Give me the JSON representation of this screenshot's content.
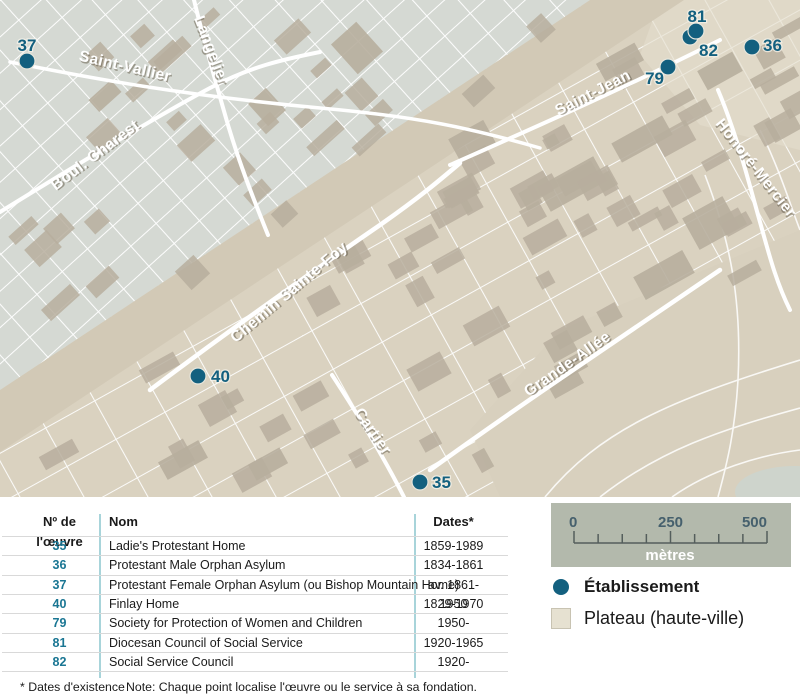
{
  "map": {
    "colors": {
      "lower_town": "#d5d9d3",
      "plateau": "#dad2c0",
      "plateau_light": "#e4ddcd",
      "slope_band": "#d2c9b6",
      "building": "#b7ae9d",
      "street": "#ffffff",
      "marker": "#13607f",
      "pond": "#ced4cc"
    },
    "street_labels": [
      {
        "name": "Saint-Vallier",
        "x": 124,
        "y": 71,
        "rotate": 13
      },
      {
        "name": "Langelier",
        "x": 207,
        "y": 52,
        "rotate": 69
      },
      {
        "name": "Boul. Charest",
        "x": 98,
        "y": 159,
        "rotate": -37
      },
      {
        "name": "Saint-Jean",
        "x": 595,
        "y": 97,
        "rotate": -27
      },
      {
        "name": "Honoré-Mercier",
        "x": 752,
        "y": 171,
        "rotate": 52
      },
      {
        "name": "Chemin Sainte-Foy",
        "x": 292,
        "y": 296,
        "rotate": -40
      },
      {
        "name": "Cartier",
        "x": 369,
        "y": 434,
        "rotate": 55
      },
      {
        "name": "Grande-Allée",
        "x": 570,
        "y": 368,
        "rotate": -35
      }
    ],
    "markers": [
      {
        "num": "37",
        "x": 27,
        "y": 61,
        "lx": 27,
        "ly": 51,
        "anchor": "middle"
      },
      {
        "num": "79",
        "x": 668,
        "y": 67,
        "lx": 664,
        "ly": 84,
        "anchor": "end"
      },
      {
        "num": "82",
        "x": 690,
        "y": 37,
        "lx": 699,
        "ly": 56,
        "anchor": "start"
      },
      {
        "num": "81",
        "x": 696,
        "y": 31,
        "lx": 697,
        "ly": 22,
        "anchor": "middle"
      },
      {
        "num": "36",
        "x": 752,
        "y": 47,
        "lx": 763,
        "ly": 51,
        "anchor": "start"
      },
      {
        "num": "40",
        "x": 198,
        "y": 376,
        "lx": 211,
        "ly": 382,
        "anchor": "start"
      },
      {
        "num": "35",
        "x": 420,
        "y": 482,
        "lx": 432,
        "ly": 488,
        "anchor": "start"
      }
    ]
  },
  "scalebar": {
    "tick_labels": [
      "0",
      "250",
      "500"
    ],
    "unit": "mètres",
    "intervals": 8
  },
  "legend": {
    "items": [
      {
        "type": "dot",
        "label": "Établissement"
      },
      {
        "type": "square",
        "label": "Plateau (haute-ville)"
      }
    ]
  },
  "table": {
    "headers": {
      "num": "Nº de l'œuvre",
      "name": "Nom",
      "dates": "Dates*"
    },
    "rows": [
      {
        "num": "35",
        "name": "Ladie's Protestant Home",
        "dates": "1859-1989"
      },
      {
        "num": "36",
        "name": "Protestant Male Orphan Asylum",
        "dates": "1834-1861"
      },
      {
        "num": "37",
        "name": "Protestant Female Orphan Asylum (ou Bishop Mountain Home)",
        "dates": "av. 1861-1950"
      },
      {
        "num": "40",
        "name": "Finlay Home",
        "dates": "1829-1970"
      },
      {
        "num": "79",
        "name": "Society for Protection of Women and Children",
        "dates": "1950-"
      },
      {
        "num": "81",
        "name": "Diocesan Council of Social Service",
        "dates": "1920-1965"
      },
      {
        "num": "82",
        "name": "Social Service Council",
        "dates": "1920-"
      }
    ],
    "footnote_left": "* Dates d'existence",
    "footnote_note": "Note: Chaque point localise l'œuvre ou le service à sa fondation."
  }
}
